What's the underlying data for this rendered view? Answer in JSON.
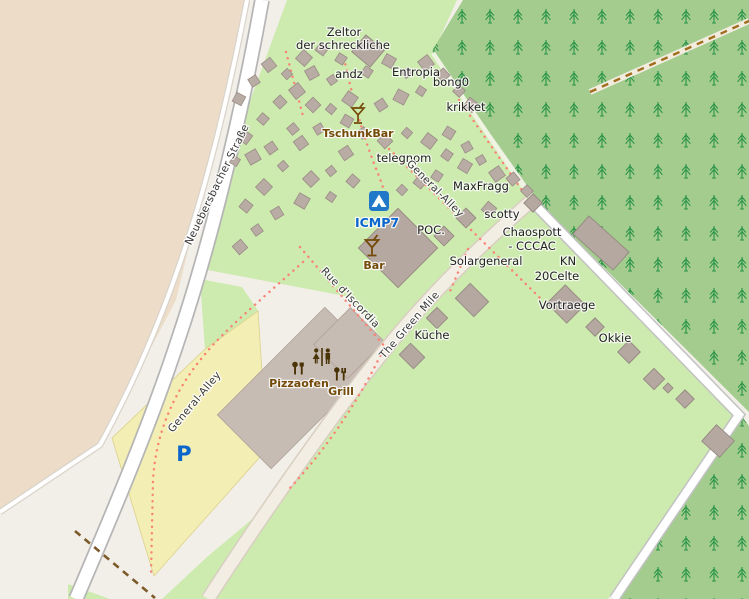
{
  "map": {
    "colors": {
      "background": "#f2efe8",
      "farmland_tan": "#ecdcc8",
      "grass_green": "#cdeaaf",
      "forest_green": "#a3cc8e",
      "tree_glyph": "#2a9448",
      "road_fill": "#ffffff",
      "road_casing": "#b5b5b5",
      "footpath_dots": "#f98274",
      "track_dash": "#a06e1e",
      "building_fill": "#b5a8a1",
      "platform_fill": "#c7bcb4",
      "parking_yellow": "#f3eeb4",
      "poi_brown": "#734a08",
      "poi_blue": "#0a65cc"
    },
    "labels": [
      {
        "name": "label-zeltor-line1",
        "text": "Zeltor",
        "x": 344,
        "y": 36,
        "cls": "place"
      },
      {
        "name": "label-zeltor-line2",
        "text": "der schreckliche",
        "x": 343,
        "y": 49,
        "cls": "place"
      },
      {
        "name": "label-andz",
        "text": "andz",
        "x": 349,
        "y": 78,
        "cls": "place"
      },
      {
        "name": "label-entropia",
        "text": "Entropia",
        "x": 416,
        "y": 76,
        "cls": "place"
      },
      {
        "name": "label-bong0",
        "text": "bong0",
        "x": 451,
        "y": 86,
        "cls": "place"
      },
      {
        "name": "label-krikket",
        "text": "krikket",
        "x": 466,
        "y": 111,
        "cls": "place"
      },
      {
        "name": "label-tschunkbar",
        "text": "TschunkBar",
        "x": 358,
        "y": 137,
        "cls": "poi"
      },
      {
        "name": "label-telegnom",
        "text": "telegnom",
        "x": 404,
        "y": 162,
        "cls": "place"
      },
      {
        "name": "label-general-alley-north",
        "text": "General-Alley",
        "x": 433,
        "y": 191,
        "cls": "road",
        "rot": 45
      },
      {
        "name": "label-maxfragg",
        "text": "MaxFragg",
        "x": 481,
        "y": 190,
        "cls": "place"
      },
      {
        "name": "label-scotty",
        "text": "scotty",
        "x": 502,
        "y": 218,
        "cls": "place"
      },
      {
        "name": "label-icmp7",
        "text": "ICMP7",
        "x": 377,
        "y": 227,
        "cls": "poib"
      },
      {
        "name": "label-poc",
        "text": "POC.",
        "x": 431,
        "y": 234,
        "cls": "place"
      },
      {
        "name": "label-chaospott",
        "text": "Chaospott",
        "x": 532,
        "y": 236,
        "cls": "place"
      },
      {
        "name": "label-cccac",
        "text": "- CCCAC",
        "x": 532,
        "y": 250,
        "cls": "place"
      },
      {
        "name": "label-kn",
        "text": "KN",
        "x": 568,
        "y": 265,
        "cls": "place"
      },
      {
        "name": "label-20celte",
        "text": "20Celte",
        "x": 557,
        "y": 280,
        "cls": "place"
      },
      {
        "name": "label-solargeneral",
        "text": "Solargeneral",
        "x": 486,
        "y": 265,
        "cls": "place"
      },
      {
        "name": "label-bar",
        "text": "Bar",
        "x": 374,
        "y": 269,
        "cls": "poi"
      },
      {
        "name": "label-rue-discordia",
        "text": "Rue d'Iscordia",
        "x": 348,
        "y": 300,
        "cls": "road",
        "rot": 46
      },
      {
        "name": "label-the-green-mile",
        "text": "The Green Mile",
        "x": 412,
        "y": 327,
        "cls": "road",
        "rot": -49
      },
      {
        "name": "label-vortraege",
        "text": "Vortraege",
        "x": 567,
        "y": 309,
        "cls": "place"
      },
      {
        "name": "label-kueche",
        "text": "Küche",
        "x": 432,
        "y": 339,
        "cls": "place"
      },
      {
        "name": "label-okkie",
        "text": "Okkie",
        "x": 615,
        "y": 342,
        "cls": "place"
      },
      {
        "name": "label-pizzaofen",
        "text": "Pizzaofen",
        "x": 299,
        "y": 387,
        "cls": "poi"
      },
      {
        "name": "label-grill",
        "text": "Grill",
        "x": 341,
        "y": 395,
        "cls": "poi"
      },
      {
        "name": "label-neuebersbacher-strasse",
        "text": "Neuebersbacher Straße",
        "x": 220,
        "y": 186,
        "cls": "road",
        "rot": -64
      },
      {
        "name": "label-general-alley-south",
        "text": "General-Alley",
        "x": 197,
        "y": 404,
        "cls": "road",
        "rot": -50
      },
      {
        "name": "label-parking-p",
        "text": "P",
        "x": 184,
        "y": 461,
        "cls": "parking"
      }
    ],
    "pois": [
      {
        "name": "TschunkBar",
        "icon": "cocktail-icon"
      },
      {
        "name": "Bar",
        "icon": "cocktail-icon"
      },
      {
        "name": "ICMP7",
        "icon": "campsite-icon"
      },
      {
        "name": "Pizzaofen",
        "icon": "bbq-icon"
      },
      {
        "name": "Grill",
        "icon": "bbq-icon"
      },
      {
        "name": "Toilets",
        "icon": "toilets-icon"
      },
      {
        "name": "Parking",
        "icon": "parking-p-icon"
      }
    ],
    "features": {
      "tents": [
        [
          239,
          99,
          10
        ],
        [
          254,
          81,
          9
        ],
        [
          269,
          65,
          11
        ],
        [
          287,
          74,
          8
        ],
        [
          304,
          58,
          12
        ],
        [
          322,
          49,
          10
        ],
        [
          341,
          59,
          9
        ],
        [
          312,
          73,
          11
        ],
        [
          332,
          80,
          8
        ],
        [
          297,
          91,
          12
        ],
        [
          280,
          102,
          10
        ],
        [
          263,
          119,
          9
        ],
        [
          245,
          137,
          11
        ],
        [
          235,
          161,
          8
        ],
        [
          253,
          157,
          12
        ],
        [
          271,
          148,
          10
        ],
        [
          293,
          129,
          9
        ],
        [
          313,
          105,
          11
        ],
        [
          331,
          109,
          8
        ],
        [
          350,
          99,
          12
        ],
        [
          347,
          121,
          10
        ],
        [
          319,
          129,
          9
        ],
        [
          301,
          143,
          11
        ],
        [
          283,
          166,
          8
        ],
        [
          264,
          187,
          12
        ],
        [
          246,
          206,
          10
        ],
        [
          367,
          72,
          9
        ],
        [
          389,
          61,
          11
        ],
        [
          407,
          73,
          8
        ],
        [
          426,
          63,
          12
        ],
        [
          443,
          75,
          10
        ],
        [
          459,
          91,
          9
        ],
        [
          471,
          105,
          11
        ],
        [
          421,
          91,
          8
        ],
        [
          401,
          97,
          12
        ],
        [
          381,
          105,
          10
        ],
        [
          363,
          133,
          9
        ],
        [
          385,
          141,
          11
        ],
        [
          407,
          133,
          8
        ],
        [
          429,
          141,
          12
        ],
        [
          449,
          133,
          10
        ],
        [
          467,
          147,
          9
        ],
        [
          346,
          153,
          11
        ],
        [
          331,
          171,
          8
        ],
        [
          311,
          179,
          12
        ],
        [
          353,
          181,
          10
        ],
        [
          447,
          155,
          9
        ],
        [
          465,
          166,
          11
        ],
        [
          481,
          160,
          8
        ],
        [
          497,
          174,
          12
        ],
        [
          513,
          179,
          10
        ],
        [
          527,
          191,
          9
        ],
        [
          489,
          209,
          11
        ],
        [
          331,
          197,
          8
        ],
        [
          302,
          201,
          12
        ],
        [
          277,
          213,
          10
        ],
        [
          257,
          230,
          9
        ],
        [
          240,
          247,
          11
        ],
        [
          402,
          190,
          8
        ],
        [
          420,
          182,
          10
        ],
        [
          437,
          176,
          9
        ]
      ],
      "buildings": [
        [
          368,
          51,
          24,
          22,
          40
        ],
        [
          398,
          248,
          56,
          56,
          45
        ],
        [
          444,
          236,
          14,
          14,
          45
        ],
        [
          466,
          218,
          14,
          14,
          45
        ],
        [
          472,
          300,
          26,
          21,
          45
        ],
        [
          437,
          318,
          15,
          15,
          45
        ],
        [
          412,
          356,
          20,
          16,
          45
        ],
        [
          533,
          203,
          13,
          13,
          45
        ],
        [
          601,
          243,
          54,
          24,
          42
        ],
        [
          566,
          304,
          28,
          26,
          45
        ],
        [
          595,
          327,
          13,
          13,
          45
        ],
        [
          629,
          352,
          16,
          16,
          45
        ],
        [
          654,
          379,
          15,
          15,
          45
        ],
        [
          668,
          388,
          7,
          7,
          45
        ],
        [
          685,
          399,
          13,
          13,
          45
        ],
        [
          718,
          441,
          24,
          22,
          42
        ]
      ]
    }
  }
}
